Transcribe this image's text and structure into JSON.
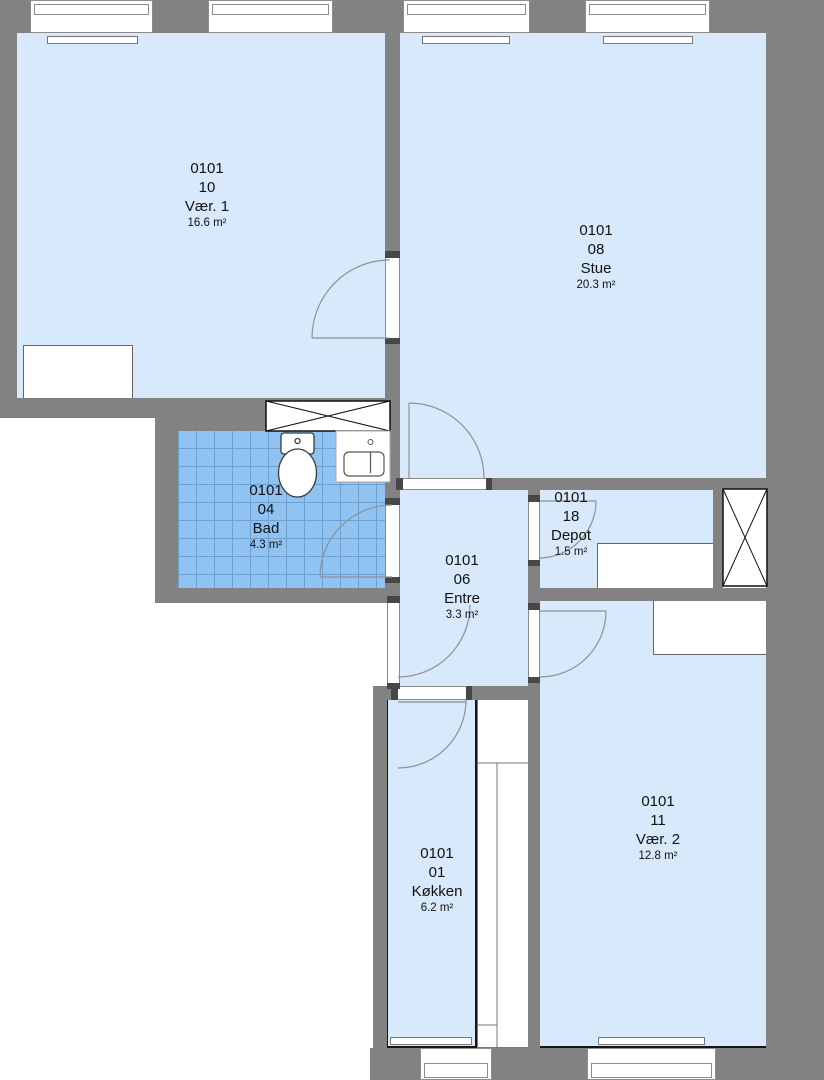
{
  "plan": {
    "rooms": [
      {
        "id": "0101",
        "number": "10",
        "name": "Vær. 1",
        "area": "16.6 m²"
      },
      {
        "id": "0101",
        "number": "08",
        "name": "Stue",
        "area": "20.3 m²"
      },
      {
        "id": "0101",
        "number": "04",
        "name": "Bad",
        "area": "4.3 m²"
      },
      {
        "id": "0101",
        "number": "06",
        "name": "Entre",
        "area": "3.3 m²"
      },
      {
        "id": "0101",
        "number": "18",
        "name": "Depot",
        "area": "1.5 m²"
      },
      {
        "id": "0101",
        "number": "01",
        "name": "Køkken",
        "area": "6.2 m²"
      },
      {
        "id": "0101",
        "number": "11",
        "name": "Vær. 2",
        "area": "12.8 m²"
      }
    ],
    "fixtures": [
      "toilet",
      "sink",
      "shaft-crossed-box",
      "bath-cabinet-crossed-box",
      "kitchen-counter",
      "radiator"
    ],
    "colors": {
      "wall": "#828282",
      "room_fill": "#d9e9fc",
      "bath_tile": "#90c3f1",
      "bath_tile_line": "#6f9fcf",
      "outline": "#161616",
      "door_arc": "#909090"
    }
  }
}
